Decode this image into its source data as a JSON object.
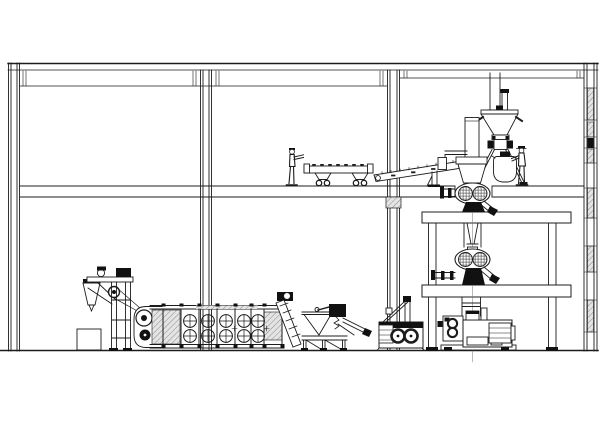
{
  "canvas": {
    "width": 600,
    "height": 421,
    "background": "#ffffff"
  },
  "palette": {
    "line": "#1c1c1c",
    "dark_fill": "#111111",
    "hatch_bg": "#e4e4e4",
    "hatch_line": "#8a8a8a",
    "centerline": "#777777"
  },
  "scene": {
    "kind": "industrial plant elevation drawing",
    "building": {
      "floors": 2,
      "roof": "flat slab",
      "columns": 2,
      "left_wall": "hollow wall section",
      "right_wall": "masonry wall with hatched blocks"
    },
    "equipment": {
      "feeder_elevator": "inclined feeder with hopper",
      "dryer": "belt dryer with fan banks",
      "dryer_fans": {
        "columns": 5,
        "rows": 2
      },
      "discharge_conveyor": "inclined discharge screw",
      "sifter": "vibrating sifter with chutes",
      "crumbler": "double roller crumbler",
      "floor_conveyor": "wheeled distribution conveyor",
      "incline_conveyor": "inclined belt conveyor",
      "tower": {
        "inlet_duct": "vertical supply duct",
        "hopper": "cone hopper with rotary valve",
        "weigh_vessel": "bag vessel",
        "upper_drum": "double drum machine",
        "lower_drum": "double drum machine",
        "ground_mill": "roller mill with motor",
        "platform_levels": 2
      }
    },
    "workers": [
      {
        "location": "second floor, beside conveyor"
      },
      {
        "location": "tower platform, beside bag vessel"
      }
    ]
  }
}
